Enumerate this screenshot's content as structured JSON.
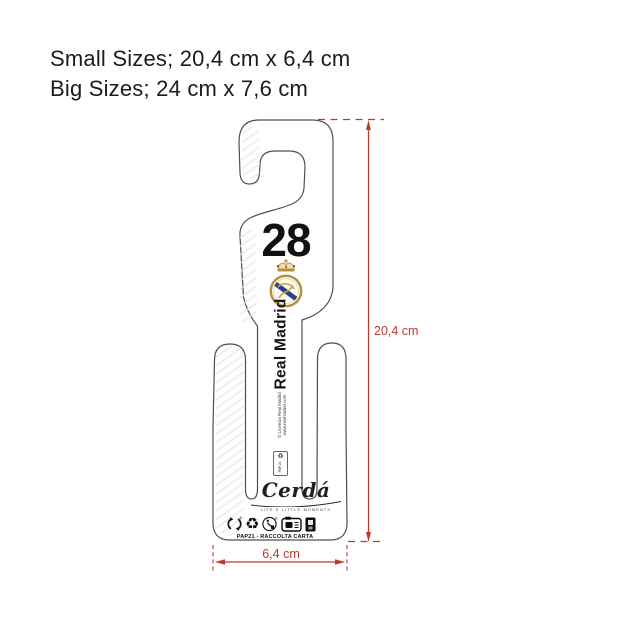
{
  "page": {
    "background": "#ffffff"
  },
  "size_note": {
    "line1": "Small Sizes; 20,4 cm x 6,4 cm",
    "line2": "Big Sizes; 24 cm x 7,6 cm"
  },
  "hanger": {
    "player_number": "28",
    "team_name": "Real Madrid",
    "license_line1": "© Licencia Real Madrid",
    "license_line2": "www.realmadrid.com",
    "triman_code": "PAP 21",
    "brand": {
      "logo_text": "Cerdá",
      "tagline": "LIFE'S LITTLE MOMENTS"
    },
    "recycling_line": "PAP21 - RACCOLTA CARTA",
    "outline_color": "#4f4f4f",
    "icons": {
      "circular_arrows": "svg-two-arc-arrows",
      "mobius_loop_glyph": "♻",
      "tidyman": "svg-person-bin",
      "paper_carton": "svg-carton-box",
      "waste_bin": "svg-dark-bin",
      "registered_mark": "®"
    }
  },
  "crest": {
    "gold": "#b3903a",
    "light_gold": "#e9dfbc",
    "blue": "#2a3f8f",
    "red": "#c23a3a",
    "field": "#fbf9f0"
  },
  "dimensions": {
    "color": "#c0392b",
    "height_label": "20,4 cm",
    "width_label": "6,4 cm"
  }
}
